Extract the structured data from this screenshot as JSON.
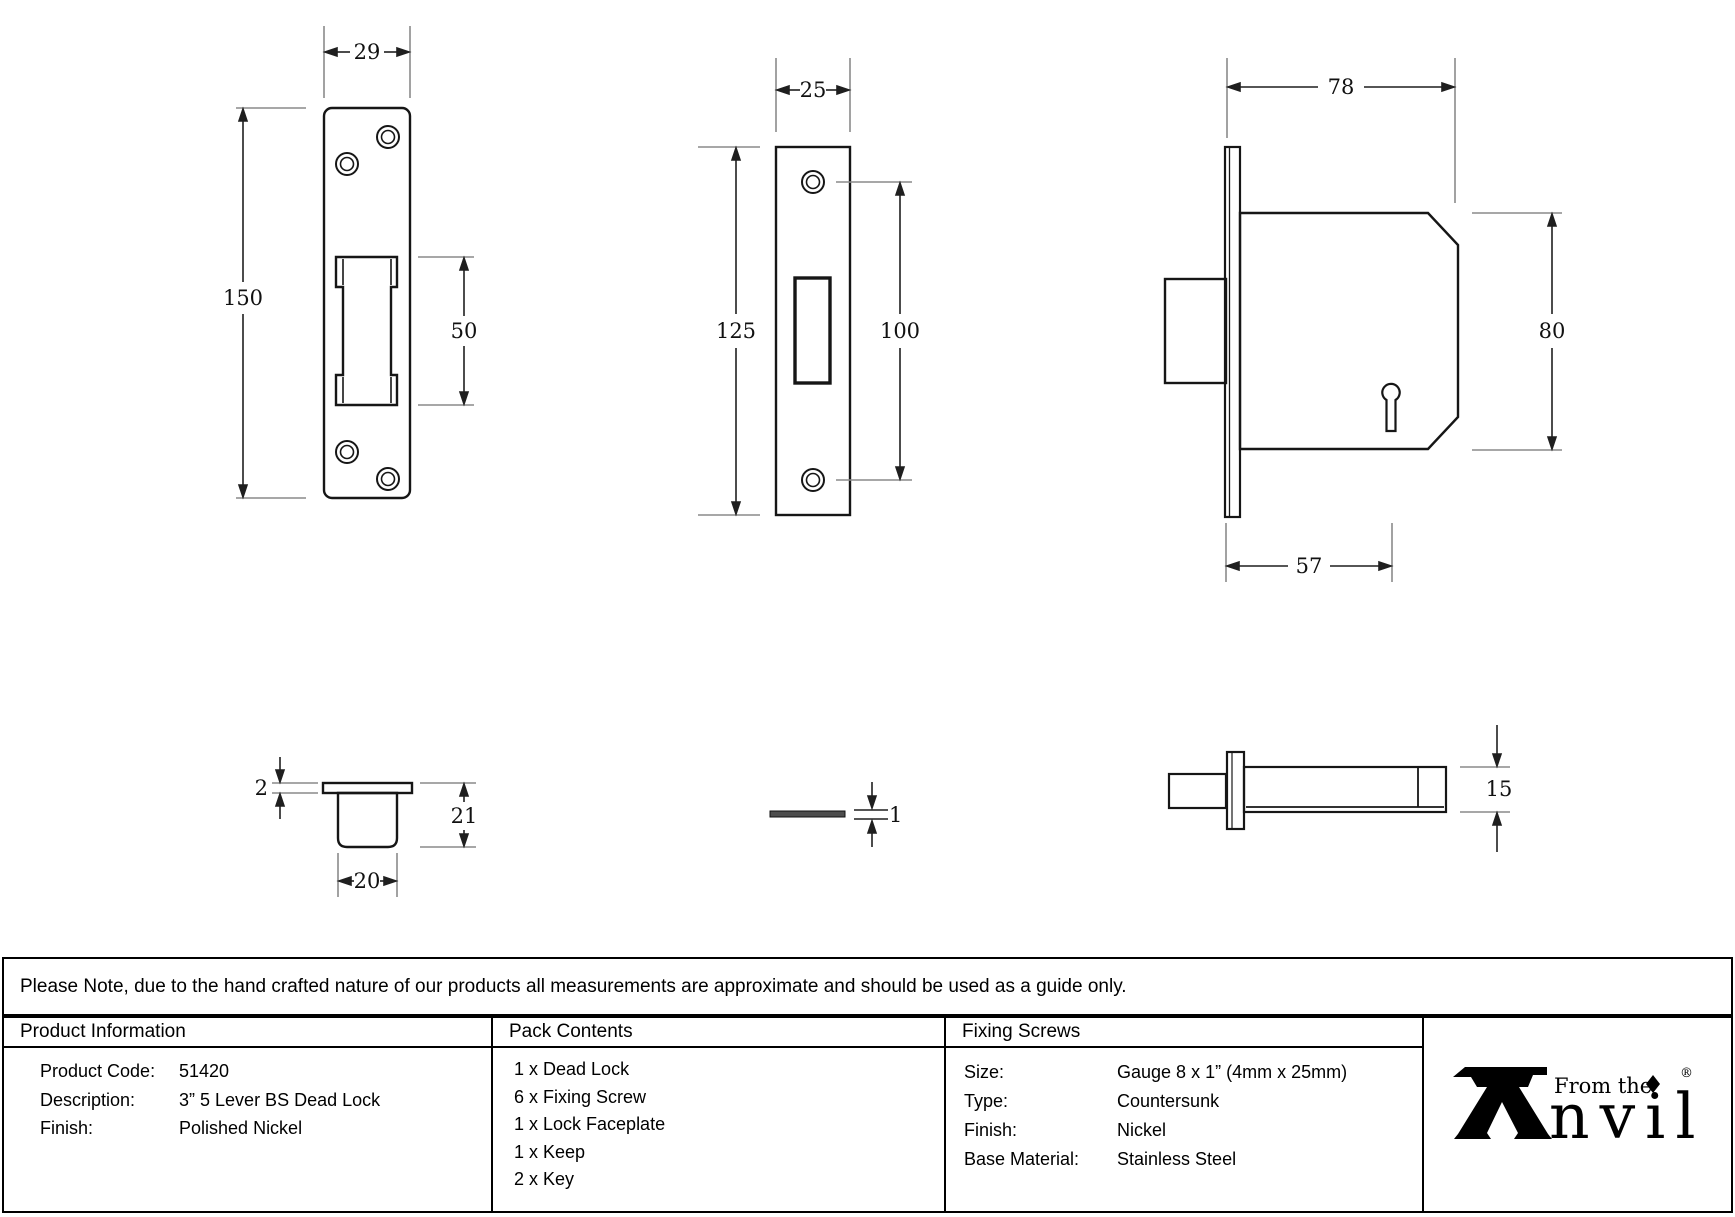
{
  "note": {
    "text": "Please Note, due to the hand crafted nature of our products all measurements are approximate and should be used as a guide only."
  },
  "drawings": {
    "keep_front": {
      "width": "29",
      "height": "150",
      "slot_height": "50"
    },
    "lock_faceplate_front": {
      "width": "25",
      "height": "125",
      "hole_spacing": "100"
    },
    "lock_body_side": {
      "depth": "78",
      "height": "80",
      "backset": "57"
    },
    "keep_section": {
      "flange_thickness": "2",
      "depth": "21",
      "width": "20"
    },
    "faceplate_edge": {
      "thickness": "1"
    },
    "lock_body_top": {
      "thickness": "15"
    }
  },
  "table": {
    "product_information": {
      "header": "Product Information",
      "rows": [
        {
          "label": "Product Code:",
          "value": "51420"
        },
        {
          "label": "Description:",
          "value": "3” 5 Lever BS Dead Lock"
        },
        {
          "label": "Finish:",
          "value": "Polished Nickel"
        }
      ]
    },
    "pack_contents": {
      "header": "Pack Contents",
      "items": [
        "1 x Dead Lock",
        "6 x Fixing Screw",
        "1 x Lock Faceplate",
        "1 x Keep",
        "2 x Key"
      ]
    },
    "fixing_screws": {
      "header": "Fixing Screws",
      "rows": [
        {
          "label": "Size:",
          "value": "Gauge 8 x 1” (4mm x 25mm)"
        },
        {
          "label": "Type:",
          "value": "Countersunk"
        },
        {
          "label": "Finish:",
          "value": "Nickel"
        },
        {
          "label": "Base Material:",
          "value": "Stainless Steel"
        }
      ]
    },
    "logo": {
      "prefix": "From the",
      "word": "nvil",
      "registered": "®"
    }
  }
}
